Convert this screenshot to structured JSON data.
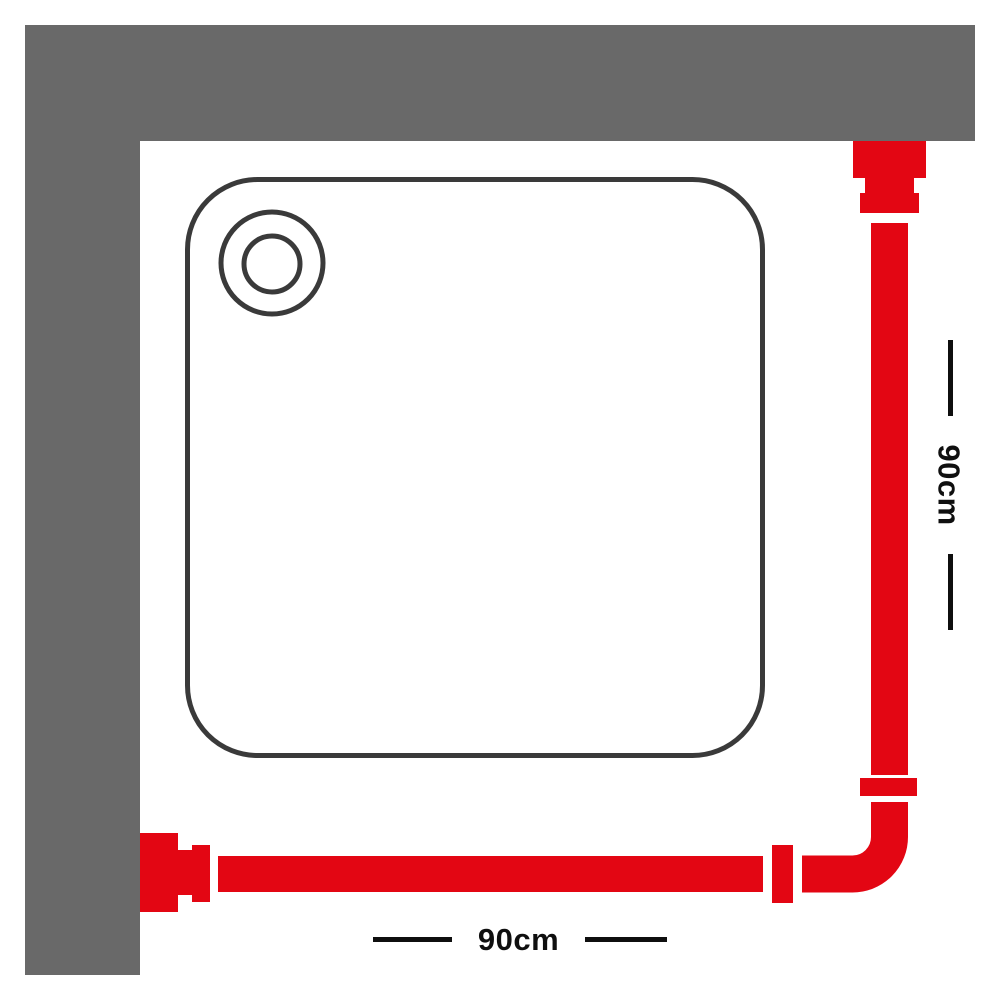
{
  "figure": {
    "labels": {
      "vertical_dimension": "90cm",
      "horizontal_dimension": "90cm"
    },
    "colors": {
      "rail_red": "#e30613",
      "wall_gray": "#696969",
      "tray_outline": "#3a3a3a",
      "tray_fill": "#ffffff",
      "dimension_ink": "#0f0f0f",
      "background": "#ffffff"
    }
  }
}
